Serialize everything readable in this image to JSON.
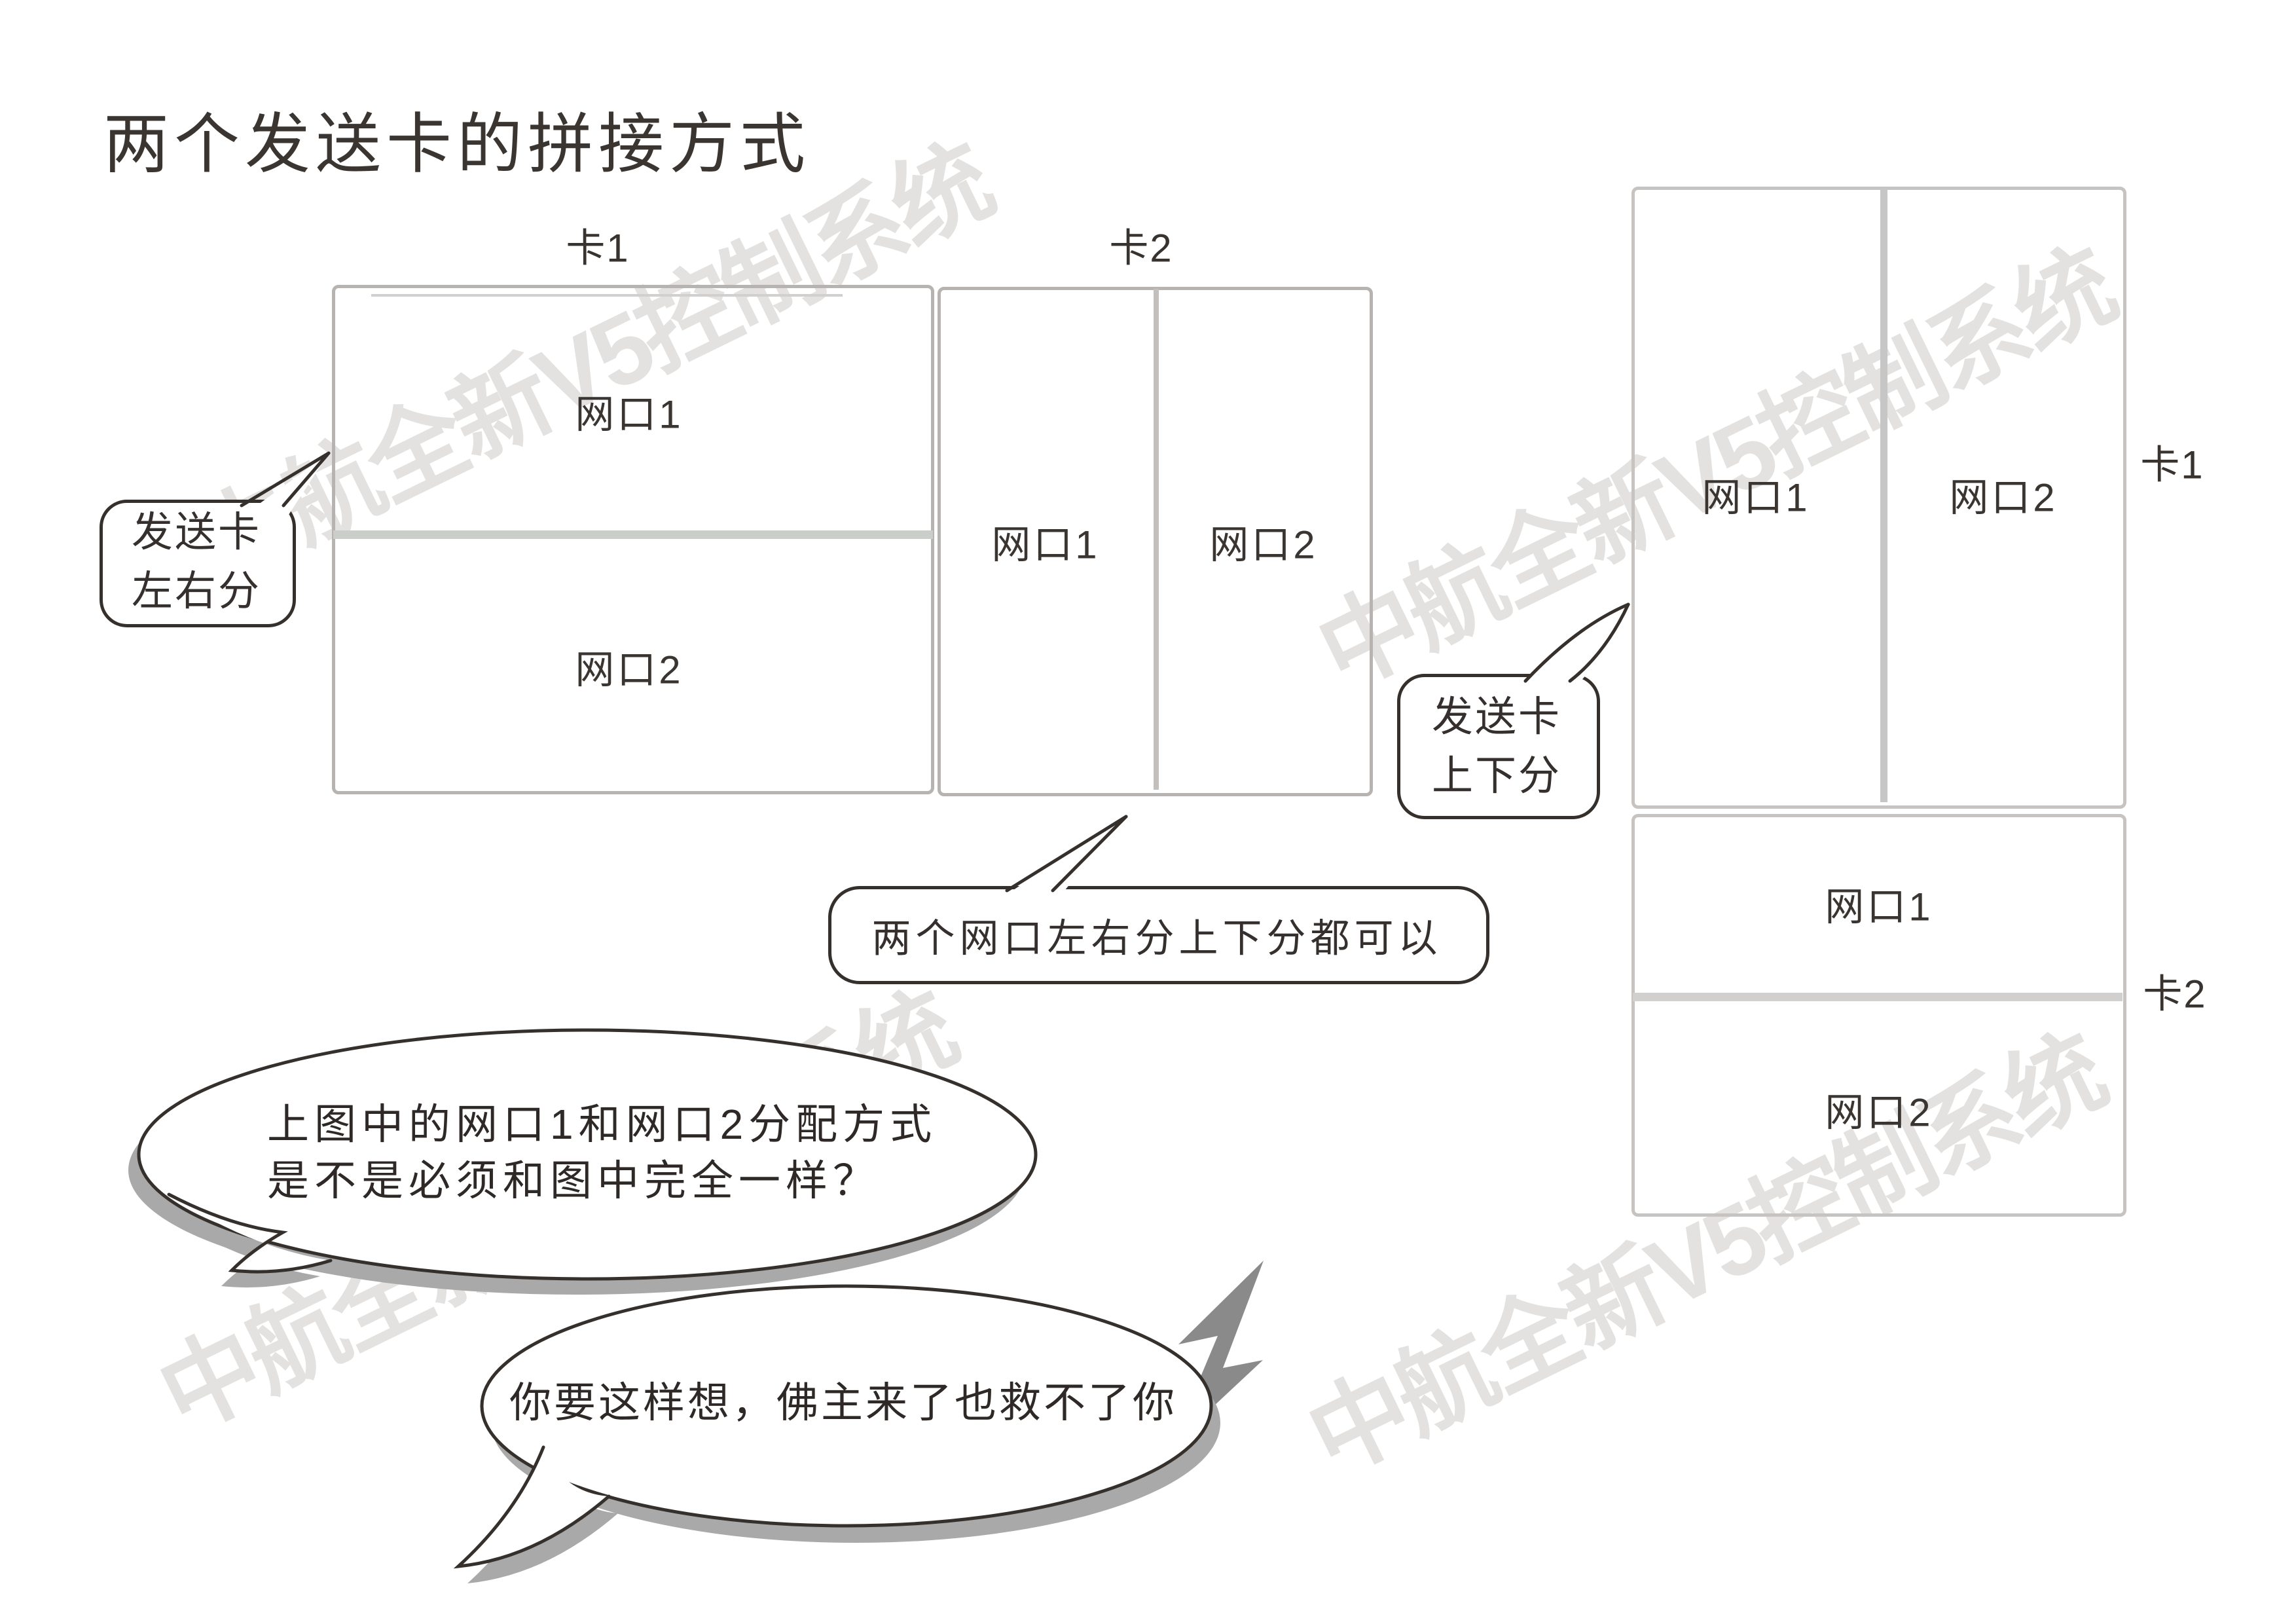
{
  "title": "两个发送卡的拼接方式",
  "watermark": {
    "text": "中航全新V5控制系统"
  },
  "cards": {
    "left": {
      "label": "卡1",
      "port1": "网口1",
      "port2": "网口2"
    },
    "middle": {
      "label": "卡2",
      "port1": "网口1",
      "port2": "网口2"
    },
    "right_top": {
      "label": "卡1",
      "port1": "网口1",
      "port2": "网口2"
    },
    "right_bottom": {
      "label": "卡2",
      "port1": "网口1",
      "port2": "网口2"
    }
  },
  "callouts": {
    "left_right_split": {
      "line1": "发送卡",
      "line2": "左右分"
    },
    "top_bottom_split": {
      "line1": "发送卡",
      "line2": "上下分"
    },
    "note": "两个网口左右分上下分都可以"
  },
  "bubbles": {
    "question_line1": "上图中的网口1和网口2分配方式",
    "question_line2": "是不是必须和图中完全一样？",
    "answer": "你要这样想，佛主来了也救不了你"
  },
  "colors": {
    "outline": "#35302c",
    "box_border": "#b7b3b0",
    "box_border_light": "#c6c3c0",
    "divider": "#cbcdcb",
    "text": "#35302e",
    "watermark": "#e3e2e0",
    "shadow": "#a9a9a9",
    "bolt": "#8a8a8a"
  }
}
